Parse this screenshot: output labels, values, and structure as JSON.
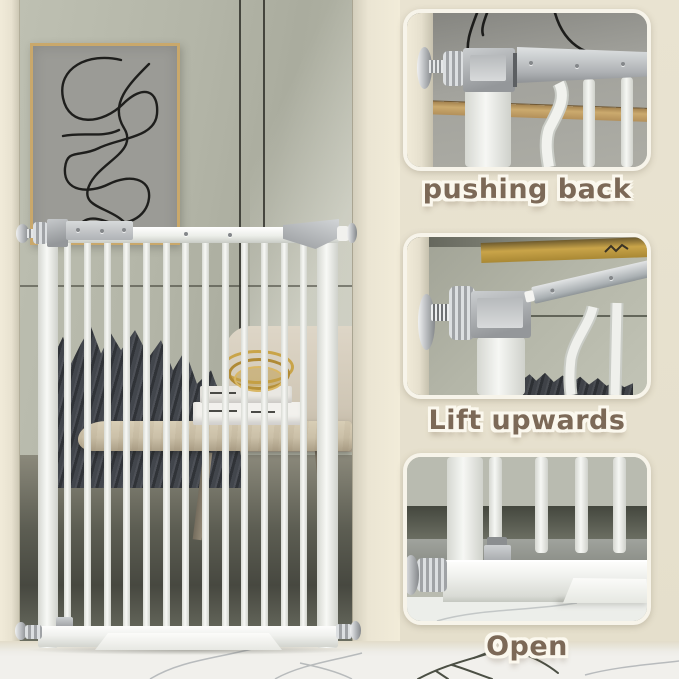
{
  "steps": [
    {
      "id": "pushing-back",
      "label": "pushing back"
    },
    {
      "id": "lift-upwards",
      "label": "Lift upwards"
    },
    {
      "id": "open",
      "label": "Open"
    }
  ],
  "colors": {
    "backdrop_beige": "#e7e1cf",
    "panel_border_cream": "#f7f4ea",
    "label_brown": "#7c6957",
    "label_outline": "#fbf8ee",
    "wall_sage": "#b2b4a6",
    "wall_cream": "#ece6d4",
    "gate_white": "#f4f5f2",
    "hardware_silver": "#b0b3b6",
    "blanket_charcoal": "#3e4147",
    "wood_tan": "#cdc2aa",
    "gold_accent": "#c9a449",
    "art_frame_tan": "#c9a86b",
    "marble_white": "#f1f0ec",
    "marble_vein_gray": "#a9adb0",
    "branch_sketch_dark": "#4b4f44"
  }
}
